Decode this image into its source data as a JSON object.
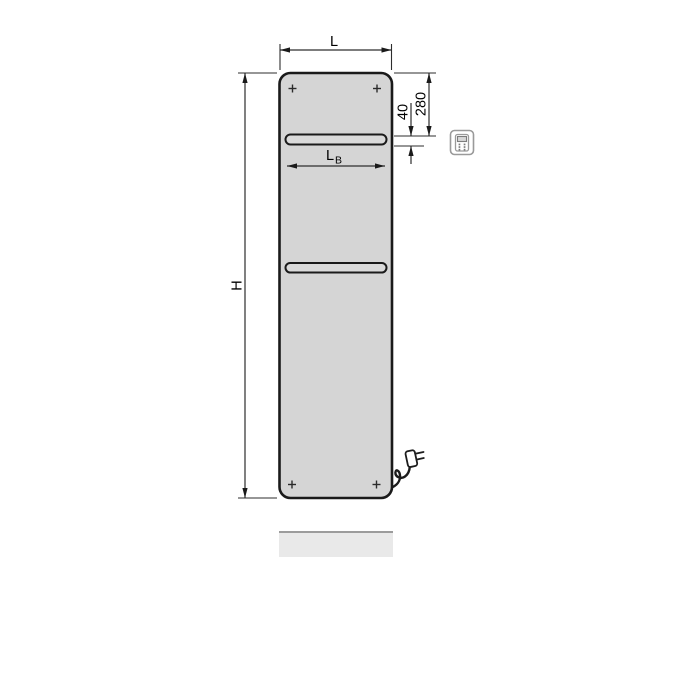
{
  "figure": {
    "title": "radiator-dimension-diagram",
    "dimensions": {
      "overall_width": {
        "label": "L"
      },
      "overall_height": {
        "label": "H"
      },
      "slot_width": {
        "label": "L",
        "subscript": "B"
      },
      "slot_top_offset": {
        "value": "280"
      },
      "slot_height": {
        "value": "40"
      }
    },
    "icons": {
      "control_unit": "control-unit-icon",
      "power_plug": "power-plug-icon",
      "mounting_marks": "plus-mark-icon"
    },
    "colors": {
      "background": "#ffffff",
      "panel_fill": "#d5d5d5",
      "panel_outline": "#1a1a1a",
      "slot_fill": "#dadada",
      "dimension_line": "#2d2d2d",
      "label_text": "#000000",
      "shadow_fill": "#e9e9e9",
      "shadow_edge": "#9c9c9c",
      "icon_outline": "#9a9a9a"
    }
  }
}
